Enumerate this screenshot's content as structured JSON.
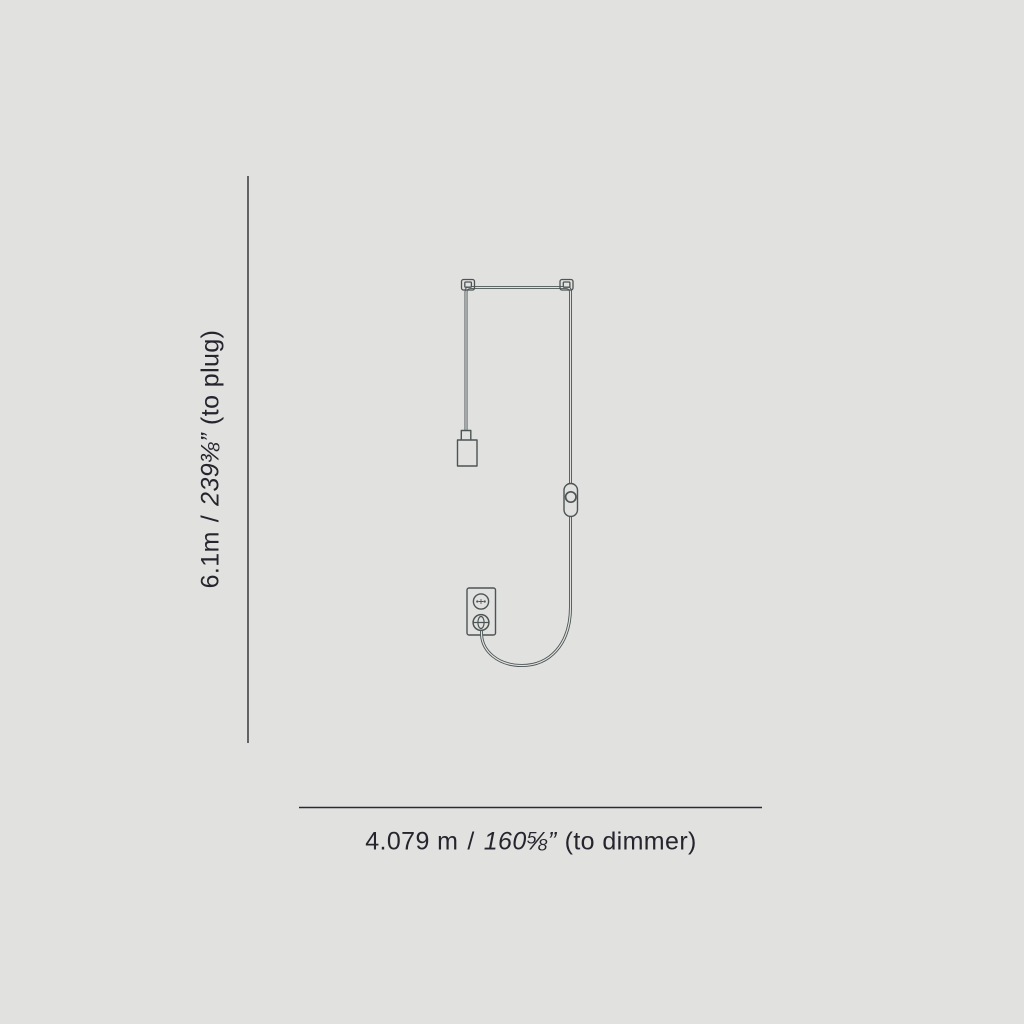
{
  "canvas": {
    "background_color": "#e1e1e0",
    "width": 1024,
    "height": 1024
  },
  "drawing": {
    "subject": "plug-in pendant lamp with cord, dimmer and wall plug",
    "stroke_color": "#4c5454",
    "background_color": "#e1e1e0",
    "parts": [
      "cord-hook-left",
      "cord-hook-right",
      "ceiling-cord-run",
      "bulb-socket",
      "inline-dimmer",
      "wall-outlet",
      "power-plug",
      "cord-curve"
    ]
  },
  "dimensions": {
    "line_color": "#2c2b34",
    "text_color": "#26252e",
    "vertical": {
      "metric": "6.1m",
      "separator": "/",
      "imperial": "239⅜”",
      "suffix": "(to plug)"
    },
    "horizontal": {
      "metric": "4.079 m",
      "separator": "/",
      "imperial": "160⅝”",
      "suffix": "(to dimmer)"
    }
  }
}
